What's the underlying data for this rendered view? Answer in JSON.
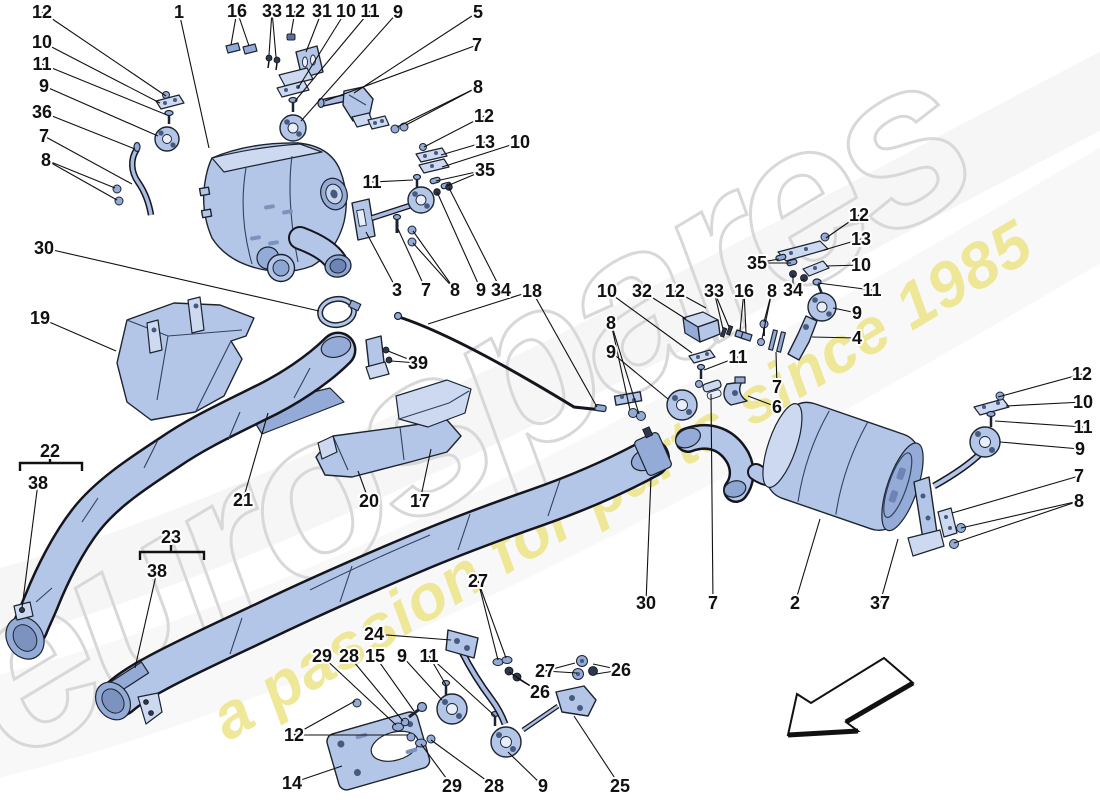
{
  "diagram": {
    "type": "exploded-parts-diagram",
    "subject": "exhaust silencer system",
    "watermark": {
      "brand": "eurospares",
      "tagline": "a passion for parts since 1985"
    },
    "colors": {
      "background": "#ffffff",
      "part_fill": "#b4c6e7",
      "part_fill_light": "#cdd9f0",
      "part_fill_dark": "#93abd6",
      "outline": "#1c2430",
      "label_color": "#111111",
      "leader_color": "#111111",
      "watermark_gray": "#d8d8d8",
      "watermark_yellow": "#ece37f"
    },
    "direction_arrow": "front-of-car-arrow (points lower-left)",
    "part_labels": [
      {
        "t": "12",
        "x": 42,
        "y": 12,
        "l": [
          [
            166,
            96
          ]
        ]
      },
      {
        "t": "10",
        "x": 42,
        "y": 42,
        "l": [
          [
            160,
            103
          ]
        ]
      },
      {
        "t": "11",
        "x": 42,
        "y": 64,
        "l": [
          [
            167,
            115
          ]
        ]
      },
      {
        "t": "9",
        "x": 44,
        "y": 86,
        "l": [
          [
            158,
            136
          ]
        ]
      },
      {
        "t": "36",
        "x": 42,
        "y": 112,
        "l": [
          [
            135,
            149
          ]
        ]
      },
      {
        "t": "7",
        "x": 44,
        "y": 136,
        "l": [
          [
            132,
            184
          ]
        ]
      },
      {
        "t": "8",
        "x": 46,
        "y": 160,
        "l": [
          [
            115,
            188
          ],
          [
            117,
            200
          ]
        ]
      },
      {
        "t": "30",
        "x": 44,
        "y": 248,
        "l": [
          [
            319,
            311
          ]
        ]
      },
      {
        "t": "19",
        "x": 40,
        "y": 318,
        "l": [
          [
            116,
            351
          ]
        ]
      },
      {
        "t": "1",
        "x": 179,
        "y": 12,
        "l": [
          [
            209,
            148
          ]
        ]
      },
      {
        "t": "16",
        "x": 237,
        "y": 11,
        "l": [
          [
            231,
            45
          ],
          [
            249,
            46
          ]
        ]
      },
      {
        "t": "33",
        "x": 272,
        "y": 11,
        "l": [
          [
            269,
            55
          ],
          [
            276,
            57
          ]
        ]
      },
      {
        "t": "12",
        "x": 295,
        "y": 11,
        "l": [
          [
            291,
            34
          ]
        ]
      },
      {
        "t": "31",
        "x": 322,
        "y": 11,
        "l": [
          [
            306,
            52
          ]
        ]
      },
      {
        "t": "10",
        "x": 346,
        "y": 11,
        "l": [
          [
            298,
            88
          ]
        ]
      },
      {
        "t": "11",
        "x": 370,
        "y": 11,
        "l": [
          [
            295,
            101
          ]
        ]
      },
      {
        "t": "9",
        "x": 398,
        "y": 12,
        "l": [
          [
            301,
            121
          ]
        ]
      },
      {
        "t": "5",
        "x": 478,
        "y": 12,
        "l": [
          [
            354,
            93
          ]
        ]
      },
      {
        "t": "7",
        "x": 477,
        "y": 45,
        "l": [
          [
            325,
            101
          ]
        ]
      },
      {
        "t": "8",
        "x": 478,
        "y": 87,
        "l": [
          [
            397,
            127
          ],
          [
            406,
            125
          ]
        ]
      },
      {
        "t": "12",
        "x": 484,
        "y": 116,
        "l": [
          [
            424,
            147
          ]
        ]
      },
      {
        "t": "13",
        "x": 485,
        "y": 142,
        "l": [
          [
            441,
            155
          ]
        ]
      },
      {
        "t": "10",
        "x": 520,
        "y": 142,
        "l": [
          [
            442,
            167
          ]
        ]
      },
      {
        "t": "35",
        "x": 485,
        "y": 170,
        "l": [
          [
            436,
            181
          ],
          [
            447,
            186
          ]
        ]
      },
      {
        "t": "11",
        "x": 372,
        "y": 182,
        "l": [
          [
            413,
            180
          ]
        ]
      },
      {
        "t": "3",
        "x": 397,
        "y": 290,
        "l": [
          [
            366,
            232
          ]
        ]
      },
      {
        "t": "7",
        "x": 426,
        "y": 290,
        "l": [
          [
            398,
            229
          ]
        ]
      },
      {
        "t": "8",
        "x": 455,
        "y": 290,
        "l": [
          [
            413,
            231
          ],
          [
            413,
            243
          ]
        ]
      },
      {
        "t": "9",
        "x": 481,
        "y": 290,
        "l": [
          [
            437,
            192
          ]
        ]
      },
      {
        "t": "34",
        "x": 501,
        "y": 290,
        "l": [
          [
            449,
            188
          ]
        ]
      },
      {
        "t": "18",
        "x": 532,
        "y": 291,
        "l": [
          [
            428,
            324
          ],
          [
            597,
            407
          ]
        ]
      },
      {
        "t": "39",
        "x": 418,
        "y": 363,
        "l": [
          [
            388,
            351
          ],
          [
            391,
            361
          ]
        ]
      },
      {
        "t": "22",
        "x": 50,
        "y": 451,
        "l": []
      },
      {
        "t": "38",
        "x": 38,
        "y": 483,
        "l": [
          [
            22,
            608
          ]
        ]
      },
      {
        "t": "23",
        "x": 171,
        "y": 537,
        "l": []
      },
      {
        "t": "38",
        "x": 157,
        "y": 571,
        "l": [
          [
            135,
            668
          ]
        ]
      },
      {
        "t": "21",
        "x": 243,
        "y": 500,
        "l": [
          [
            268,
            413
          ]
        ]
      },
      {
        "t": "20",
        "x": 369,
        "y": 501,
        "l": [
          [
            358,
            471
          ]
        ]
      },
      {
        "t": "17",
        "x": 420,
        "y": 501,
        "l": [
          [
            431,
            449
          ]
        ]
      },
      {
        "t": "10",
        "x": 607,
        "y": 291,
        "l": [
          [
            692,
            353
          ]
        ]
      },
      {
        "t": "32",
        "x": 642,
        "y": 291,
        "l": [
          [
            686,
            319
          ]
        ]
      },
      {
        "t": "12",
        "x": 675,
        "y": 291,
        "l": [
          [
            706,
            308
          ]
        ]
      },
      {
        "t": "33",
        "x": 714,
        "y": 291,
        "l": [
          [
            723,
            329
          ],
          [
            729,
            327
          ]
        ]
      },
      {
        "t": "16",
        "x": 744,
        "y": 291,
        "l": [
          [
            740,
            331
          ],
          [
            746,
            333
          ]
        ]
      },
      {
        "t": "8",
        "x": 772,
        "y": 291,
        "l": [
          [
            764,
            322
          ],
          [
            762,
            339
          ]
        ]
      },
      {
        "t": "34",
        "x": 793,
        "y": 290,
        "l": [
          [
            793,
            275
          ],
          [
            804,
            279
          ]
        ]
      },
      {
        "t": "11",
        "x": 872,
        "y": 290,
        "l": [
          [
            818,
            283
          ]
        ]
      },
      {
        "t": "9",
        "x": 857,
        "y": 313,
        "l": [
          [
            833,
            308
          ]
        ]
      },
      {
        "t": "4",
        "x": 857,
        "y": 338,
        "l": [
          [
            812,
            337
          ]
        ]
      },
      {
        "t": "8",
        "x": 611,
        "y": 323,
        "l": [
          [
            630,
            410
          ],
          [
            639,
            414
          ]
        ]
      },
      {
        "t": "9",
        "x": 611,
        "y": 352,
        "l": [
          [
            668,
            399
          ]
        ]
      },
      {
        "t": "11",
        "x": 738,
        "y": 357,
        "l": [
          [
            704,
            370
          ]
        ]
      },
      {
        "t": "7",
        "x": 777,
        "y": 387,
        "l": [
          [
            776,
            352
          ]
        ]
      },
      {
        "t": "6",
        "x": 777,
        "y": 407,
        "l": [
          [
            748,
            396
          ]
        ]
      },
      {
        "t": "12",
        "x": 859,
        "y": 215,
        "l": [
          [
            826,
            238
          ]
        ]
      },
      {
        "t": "13",
        "x": 861,
        "y": 239,
        "l": [
          [
            824,
            250
          ]
        ]
      },
      {
        "t": "35",
        "x": 757,
        "y": 263,
        "l": [
          [
            779,
            259
          ],
          [
            791,
            263
          ]
        ]
      },
      {
        "t": "10",
        "x": 861,
        "y": 265,
        "l": [
          [
            826,
            266
          ]
        ]
      },
      {
        "t": "30",
        "x": 646,
        "y": 603,
        "l": [
          [
            651,
            477
          ]
        ]
      },
      {
        "t": "7",
        "x": 713,
        "y": 603,
        "l": [
          [
            711,
            394
          ]
        ]
      },
      {
        "t": "2",
        "x": 795,
        "y": 603,
        "l": [
          [
            820,
            519
          ]
        ]
      },
      {
        "t": "37",
        "x": 880,
        "y": 603,
        "l": [
          [
            898,
            539
          ]
        ]
      },
      {
        "t": "12",
        "x": 1082,
        "y": 374,
        "l": [
          [
            998,
            397
          ]
        ]
      },
      {
        "t": "10",
        "x": 1083,
        "y": 402,
        "l": [
          [
            1006,
            406
          ]
        ]
      },
      {
        "t": "11",
        "x": 1083,
        "y": 427,
        "l": [
          [
            995,
            421
          ]
        ]
      },
      {
        "t": "9",
        "x": 1080,
        "y": 449,
        "l": [
          [
            1000,
            442
          ]
        ]
      },
      {
        "t": "7",
        "x": 1079,
        "y": 476,
        "l": [
          [
            952,
            513
          ]
        ]
      },
      {
        "t": "8",
        "x": 1079,
        "y": 501,
        "l": [
          [
            961,
            528
          ],
          [
            954,
            543
          ]
        ]
      },
      {
        "t": "24",
        "x": 374,
        "y": 634,
        "l": [
          [
            451,
            640
          ]
        ]
      },
      {
        "t": "29",
        "x": 322,
        "y": 656,
        "l": [
          [
            396,
            725
          ]
        ]
      },
      {
        "t": "28",
        "x": 349,
        "y": 656,
        "l": [
          [
            403,
            721
          ]
        ]
      },
      {
        "t": "15",
        "x": 375,
        "y": 656,
        "l": [
          [
            414,
            711
          ]
        ]
      },
      {
        "t": "9",
        "x": 402,
        "y": 656,
        "l": [
          [
            442,
            700
          ]
        ]
      },
      {
        "t": "11",
        "x": 429,
        "y": 656,
        "l": [
          [
            446,
            685
          ],
          [
            495,
            716
          ]
        ]
      },
      {
        "t": "12",
        "x": 294,
        "y": 735,
        "l": [
          [
            355,
            701
          ],
          [
            408,
            735
          ]
        ]
      },
      {
        "t": "14",
        "x": 292,
        "y": 783,
        "l": [
          [
            342,
            766
          ]
        ]
      },
      {
        "t": "29",
        "x": 452,
        "y": 786,
        "l": [
          [
            421,
            744
          ]
        ]
      },
      {
        "t": "28",
        "x": 494,
        "y": 786,
        "l": [
          [
            431,
            740
          ]
        ]
      },
      {
        "t": "9",
        "x": 543,
        "y": 786,
        "l": [
          [
            508,
            752
          ]
        ]
      },
      {
        "t": "25",
        "x": 620,
        "y": 786,
        "l": [
          [
            574,
            716
          ]
        ]
      },
      {
        "t": "27",
        "x": 478,
        "y": 581,
        "l": [
          [
            498,
            660
          ],
          [
            506,
            658
          ]
        ]
      },
      {
        "t": "26",
        "x": 540,
        "y": 692,
        "l": [
          [
            509,
            672
          ],
          [
            517,
            678
          ]
        ]
      },
      {
        "t": "27",
        "x": 545,
        "y": 671,
        "l": [
          [
            575,
            663
          ],
          [
            577,
            673
          ]
        ]
      },
      {
        "t": "26",
        "x": 621,
        "y": 670,
        "l": [
          [
            593,
            664
          ],
          [
            596,
            674
          ]
        ]
      }
    ],
    "braces": [
      {
        "label": "22",
        "x1": 20,
        "x2": 82,
        "y": 463,
        "notch": 50
      },
      {
        "label": "23",
        "x1": 140,
        "x2": 204,
        "y": 552,
        "notch": 171
      }
    ]
  }
}
